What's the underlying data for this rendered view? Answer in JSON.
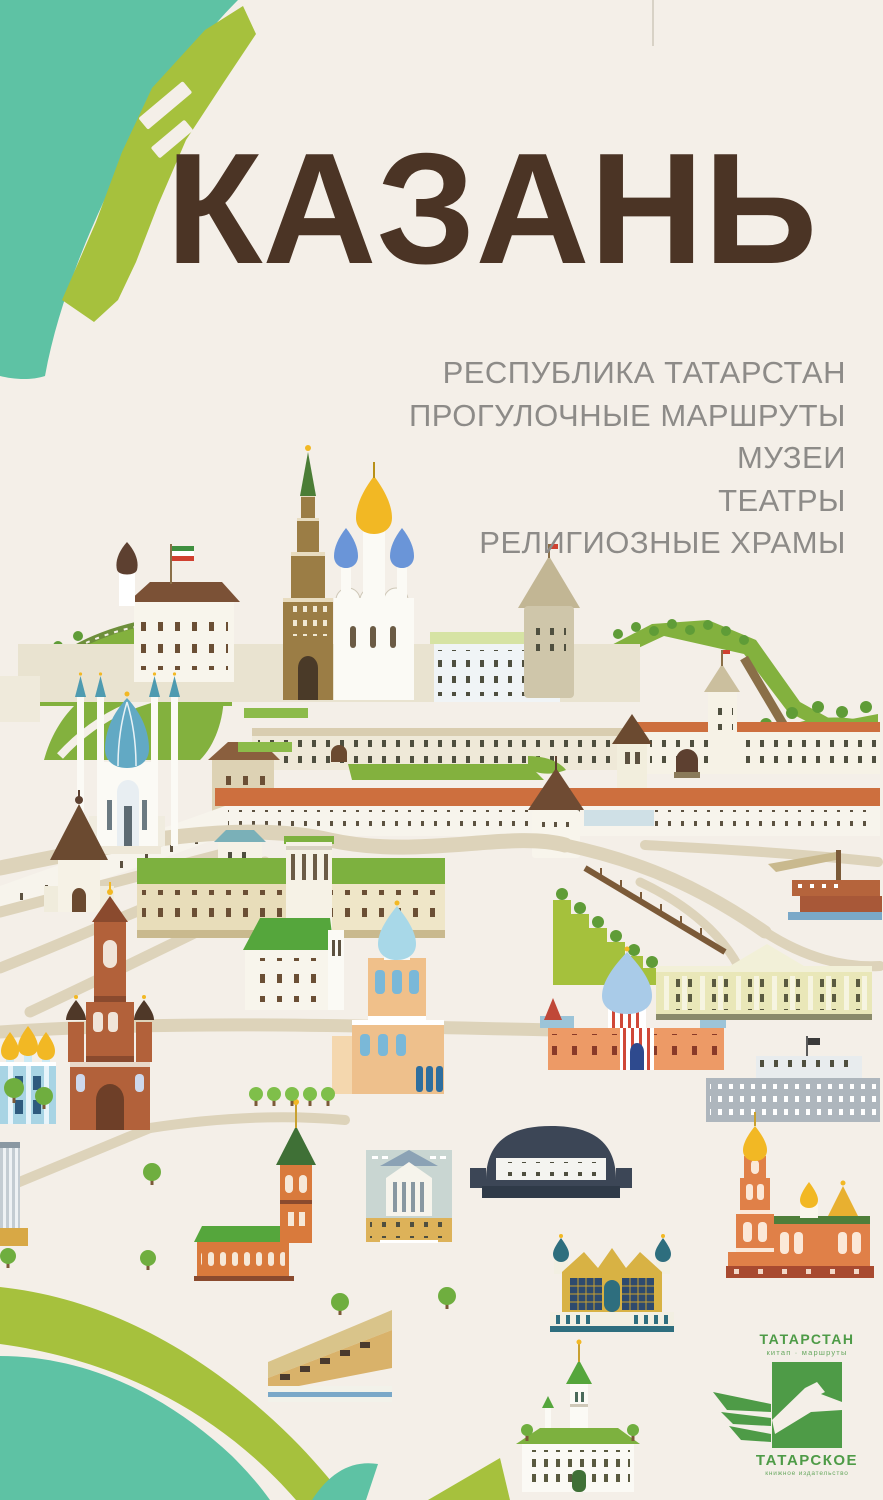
{
  "cover": {
    "title": "КАЗАНЬ",
    "subtitle_lines": [
      "РЕСПУБЛИКА ТАТАРСТАН",
      "ПРОГУЛОЧНЫЕ МАРШРУТЫ",
      "МУЗЕИ",
      "ТЕАТРЫ",
      "РЕЛИГИОЗНЫЕ ХРАМЫ"
    ]
  },
  "publisher": {
    "series_title": "ТАТАРСТАН",
    "series_subtitle": "китап · маршруты",
    "name": "ТАТАРСКОЕ",
    "name_subtitle": "книжное издательство"
  },
  "colors": {
    "background": "#f4efe8",
    "title_brown": "#4b3425",
    "subtitle_gray": "#8d8b88",
    "river_teal": "#5ec2a4",
    "land_lime": "#a6c13d",
    "grass_green": "#83b13e",
    "roof_orange": "#cd6f3e",
    "brick_red": "#b2613a",
    "dome_blue": "#6a95d8",
    "dome_teal": "#62a9c4",
    "dome_gold": "#f2b824",
    "wall_white": "#f7f4ec",
    "road_beige": "#ddd3ba",
    "logo_green": "#4e9b47"
  },
  "illustration": {
    "landmarks": [
      "kazan-kremlin",
      "kul-sharif-mosque",
      "soyembika-tower",
      "annunciation-cathedral",
      "governor-palace",
      "kremlin-walls-and-towers",
      "spasskaya-tower",
      "epiphany-bell-tower",
      "university-main-building",
      "bogoroditsky-monastery",
      "opera-ballet-theatre",
      "kamal-theatre",
      "old-town-hall",
      "government-house",
      "concert-hall",
      "ornamental-mosque",
      "orange-church-bell-tower",
      "riverport",
      "kaban-lake",
      "river-map-shapes",
      "trees"
    ]
  }
}
